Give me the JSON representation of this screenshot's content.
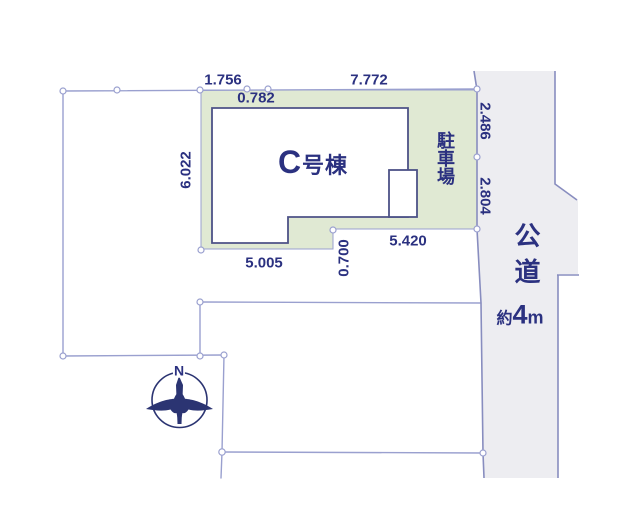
{
  "diagram_type": "real-estate site plan",
  "colors": {
    "navy": "#2b3180",
    "line": "#9aa0cf",
    "road_line": "#888dbf",
    "plot_green": "#e0e9d3",
    "road_gray": "#ededf1",
    "building_outline": "#4d5287",
    "compass_navy": "#2b3472"
  },
  "dimensions": {
    "top_left": "1.756",
    "top_right": "7.772",
    "building_top_offset": "0.782",
    "left_side": "6.022",
    "road_frontage_upper": "2.486",
    "road_frontage_lower": "2.804",
    "parking_bottom": "5.420",
    "step_offset": "0.700",
    "building_bottom": "5.005"
  },
  "building": {
    "name_prefix": "C",
    "name_suffix": "号棟"
  },
  "parking": {
    "label": "駐車場"
  },
  "road": {
    "label": "公道",
    "width_prefix": "約",
    "width_value": "4",
    "width_unit": "m"
  },
  "compass": {
    "north_label": "N"
  }
}
